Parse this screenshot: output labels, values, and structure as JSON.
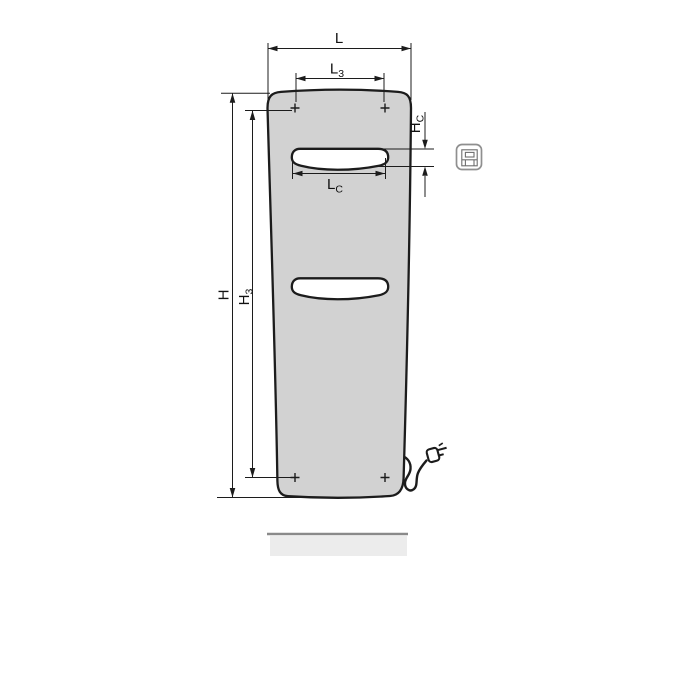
{
  "drawing": {
    "kind": "radiator-technical-dimension-diagram",
    "labels": {
      "L": {
        "main": "L",
        "sub": ""
      },
      "L3": {
        "main": "L",
        "sub": "3"
      },
      "H": {
        "main": "H",
        "sub": ""
      },
      "H3": {
        "main": "H",
        "sub": "3"
      },
      "HC": {
        "main": "H",
        "sub": "C"
      },
      "LC": {
        "main": "L",
        "sub": "C"
      }
    },
    "colors": {
      "line": "#1c1c1c",
      "body_fill": "#d2d2d2",
      "slot_fill": "#ffffff",
      "shadow_fill": "#ececec",
      "shadow_edge": "#8a8a8a",
      "icon_stroke": "#8f8f8f",
      "icon_inner": "#6e6e6e"
    }
  }
}
